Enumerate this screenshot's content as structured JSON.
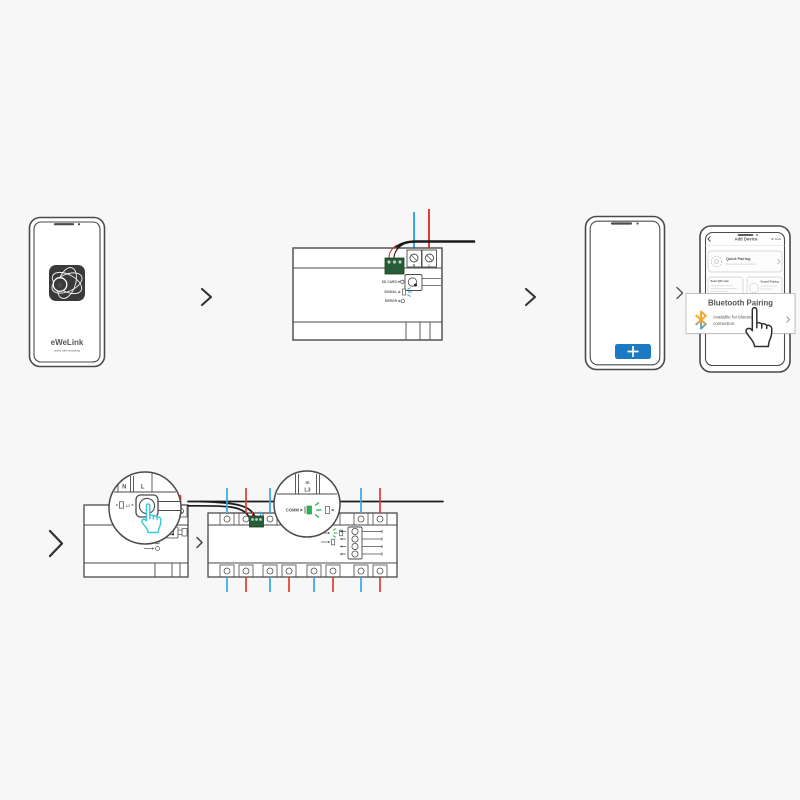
{
  "colors": {
    "background": "#f7f7f7",
    "line": "#4a4a4a",
    "wire_red": "#e03c31",
    "wire_blue": "#3aa7e8",
    "accent_blue": "#1b7ac1",
    "led_green": "#2faf4e",
    "led_blue": "#2a9fd8",
    "hand_cyan": "#3cc8d8",
    "connector_green": "#265c36",
    "bluetooth_orange": "#f5a623",
    "bluetooth_blue": "#3d9fe0"
  },
  "step1_phone": {
    "app_letter": "e",
    "app_name": "eWeLink",
    "tagline": "works with everything"
  },
  "step2_device": {
    "terminal_n": "N",
    "terminal_l": "L",
    "indicator_sd": "SD CARD",
    "indicator_signal": "SIGNAL",
    "indicator_error": "ERROR"
  },
  "step3_phone": {
    "plus_label": "+"
  },
  "step4_phone": {
    "header_title": "Add Device",
    "header_action": "AP Mode",
    "quick_pairing": "Quick Pairing",
    "card_scan": "Scan QR code",
    "card_sound": "Sound Pairing",
    "popup": {
      "title": "Bluetooth Pairing",
      "line1": "Available for bluetooth",
      "line2": "connection."
    }
  },
  "step5_device": {
    "terminal_n": "N",
    "terminal_l": "L",
    "led_label": "L1"
  },
  "step6_device": {
    "terminal_in": "In",
    "terminal_l3": "L3",
    "comm_label": "COMM"
  }
}
